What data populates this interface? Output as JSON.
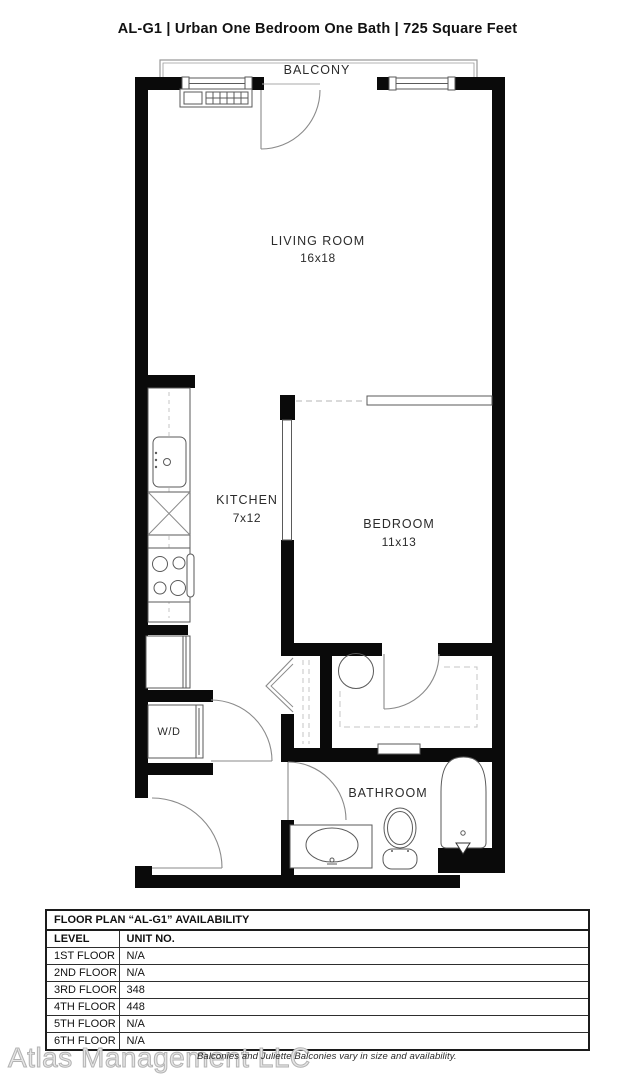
{
  "header": {
    "title": "AL-G1 | Urban One Bedroom One Bath | 725 Square Feet"
  },
  "plan": {
    "balcony": {
      "label": "BALCONY"
    },
    "living_room": {
      "label": "LIVING ROOM",
      "dims": "16x18"
    },
    "kitchen": {
      "label": "KITCHEN",
      "dims": "7x12"
    },
    "bedroom": {
      "label": "BEDROOM",
      "dims": "11x13"
    },
    "bathroom": {
      "label": "BATHROOM"
    },
    "washer_dryer": {
      "label": "W/D"
    },
    "fixtures": [
      "balcony-railing",
      "baseboard-heater",
      "window",
      "balcony-door",
      "sliding-bedroom-door",
      "pocket-door-panel",
      "kitchen-sink",
      "dishwasher",
      "stove",
      "refrigerator",
      "washer-dryer",
      "wd-closet-door",
      "bifold-closet-door",
      "closet-shelving",
      "water-heater",
      "walkin-closet-door",
      "bathroom-door",
      "vanity-sink",
      "toilet",
      "bathtub",
      "entry-door",
      "wall-niche"
    ]
  },
  "availability_table": {
    "title": "FLOOR PLAN “AL-G1” AVAILABILITY",
    "columns": [
      "LEVEL",
      "UNIT NO."
    ],
    "rows": [
      [
        "1ST FLOOR",
        "N/A"
      ],
      [
        "2ND FLOOR",
        "N/A"
      ],
      [
        "3RD FLOOR",
        "348"
      ],
      [
        "4TH FLOOR",
        "448"
      ],
      [
        "5TH FLOOR",
        "N/A"
      ],
      [
        "6TH FLOOR",
        "N/A"
      ]
    ]
  },
  "footer": {
    "watermark": "Atlas Management LLC",
    "note": "Balconies and Juliette Balconies vary in size and availability."
  },
  "colors": {
    "wall": "#0a0a0a",
    "fixture_line": "#5a5a5a",
    "door_line": "#8a8a8a",
    "dashed_line": "#c4c4c4",
    "watermark": "#b3b3b3",
    "text": "#111111"
  }
}
